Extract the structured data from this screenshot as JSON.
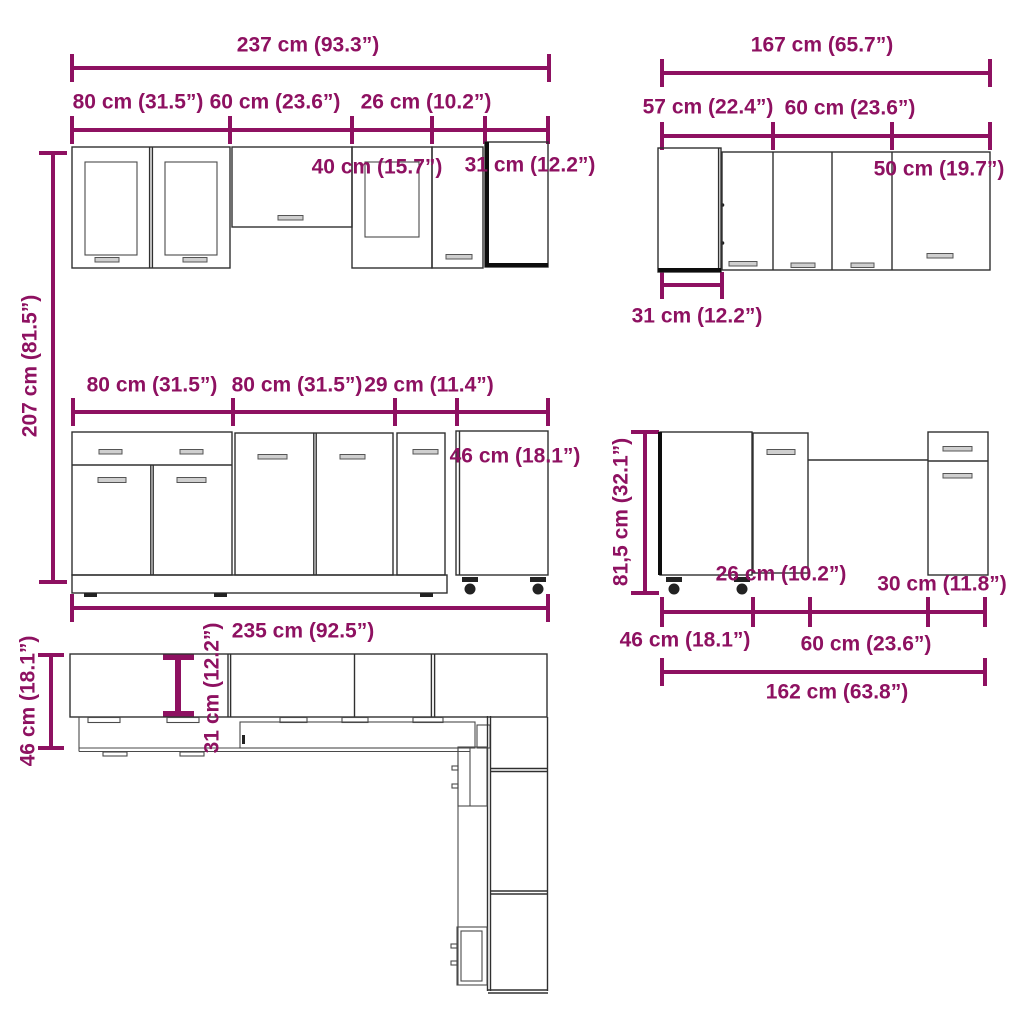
{
  "colors": {
    "accent": "#8E1161",
    "line": "#303030",
    "background": "#ffffff"
  },
  "wall_run": {
    "total": "237 cm (93.3”)",
    "seg_80": "80 cm (31.5”)",
    "seg_60": "60 cm (23.6”)",
    "seg_26": "26 cm (10.2”)",
    "inner_40": "40 cm (15.7”)",
    "inner_31": "31 cm (12.2”)"
  },
  "corner_wall_run": {
    "total": "167 cm (65.7”)",
    "seg_57": "57 cm (22.4”)",
    "seg_60": "60 cm (23.6”)",
    "inner_50": "50 cm (19.7”)",
    "bottom_31": "31 cm (12.2”)"
  },
  "base_run": {
    "height_207": "207 cm (81.5”)",
    "seg_80a": "80 cm (31.5”)",
    "seg_80b": "80 cm (31.5”)",
    "seg_29": "29 cm (11.4”)",
    "inner_46": "46 cm (18.1”)",
    "total": "235 cm (92.5”)"
  },
  "corner_base_run": {
    "height_815": "81,5 cm (32.1”)",
    "inner_26": "26 cm (10.2”)",
    "inner_30": "30 cm (11.8”)",
    "seg_46": "46 cm (18.1”)",
    "seg_60": "60 cm (23.6”)",
    "total": "162 cm (63.8”)"
  },
  "plan_view": {
    "base_depth_46": "46 cm (18.1”)",
    "wall_depth_31": "31 cm (12.2”)"
  }
}
